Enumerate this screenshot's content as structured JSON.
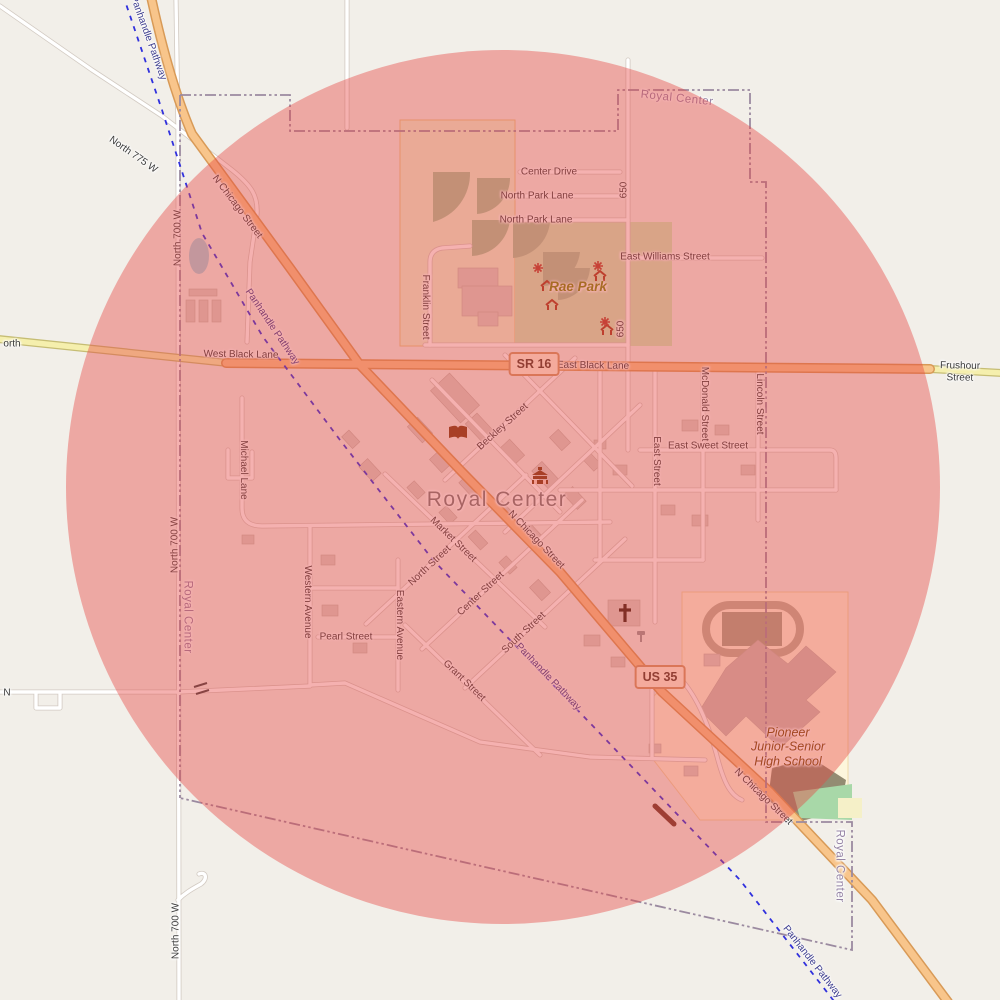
{
  "map": {
    "town_name": "Royal Center",
    "overlay": {
      "shape": "circle",
      "color": "#e84642",
      "opacity": 0.42,
      "cx": 503,
      "cy": 487,
      "r": 437
    },
    "badges": [
      {
        "id": "route-sr16",
        "label": "SR 16",
        "x": 534,
        "y": 364
      },
      {
        "id": "route-us35",
        "label": "US 35",
        "x": 660,
        "y": 677
      }
    ],
    "labels": [
      {
        "text": "orth",
        "x": 12,
        "y": 344,
        "rot": 0,
        "cls": "road"
      },
      {
        "text": "North 775 W",
        "x": 133,
        "y": 155,
        "rot": 35,
        "cls": "road"
      },
      {
        "text": "Panhandle Pathway",
        "x": 148,
        "y": 38,
        "rot": 70,
        "cls": "path-label"
      },
      {
        "text": "N Chicago Street",
        "x": 237,
        "y": 207,
        "rot": 53,
        "cls": "road"
      },
      {
        "text": "North 700 W",
        "x": 178,
        "y": 238,
        "rot": -90,
        "cls": "road"
      },
      {
        "text": "Panhandle Pathway",
        "x": 272,
        "y": 327,
        "rot": 56,
        "cls": "path-label"
      },
      {
        "text": "West Black Lane",
        "x": 241,
        "y": 355,
        "rot": 1,
        "cls": "road"
      },
      {
        "text": "East Black Lane",
        "x": 593,
        "y": 366,
        "rot": 1,
        "cls": "road"
      },
      {
        "text": "Frushour Street",
        "x": 960,
        "y": 372,
        "rot": 1,
        "cls": "road"
      },
      {
        "text": "Royal Center",
        "x": 677,
        "y": 99,
        "rot": 6,
        "cls": "boundary"
      },
      {
        "text": "650",
        "x": 624,
        "y": 190,
        "rot": -90,
        "cls": "road"
      },
      {
        "text": "650",
        "x": 621,
        "y": 329,
        "rot": -90,
        "cls": "road"
      },
      {
        "text": "Center Drive",
        "x": 549,
        "y": 172,
        "rot": 0,
        "cls": "road"
      },
      {
        "text": "North Park Lane",
        "x": 537,
        "y": 196,
        "rot": 0,
        "cls": "road"
      },
      {
        "text": "North Park Lane",
        "x": 536,
        "y": 220,
        "rot": 0,
        "cls": "road"
      },
      {
        "text": "East Williams Street",
        "x": 665,
        "y": 257,
        "rot": 0,
        "cls": "road"
      },
      {
        "text": "Rae Park",
        "x": 578,
        "y": 287,
        "rot": 0,
        "cls": "park"
      },
      {
        "text": "Franklin Street",
        "x": 425,
        "y": 307,
        "rot": 90,
        "cls": "road"
      },
      {
        "text": "Beckley Street",
        "x": 503,
        "y": 427,
        "rot": -42,
        "cls": "road"
      },
      {
        "text": "McDonald Street",
        "x": 704,
        "y": 404,
        "rot": 90,
        "cls": "road"
      },
      {
        "text": "Lincoln Street",
        "x": 759,
        "y": 404,
        "rot": 90,
        "cls": "road"
      },
      {
        "text": "East Street",
        "x": 656,
        "y": 461,
        "rot": 90,
        "cls": "road"
      },
      {
        "text": "East Sweet Street",
        "x": 708,
        "y": 446,
        "rot": 0,
        "cls": "road"
      },
      {
        "text": "Royal Center",
        "x": 497,
        "y": 500,
        "rot": 0,
        "cls": "town"
      },
      {
        "text": "N Chicago Street",
        "x": 536,
        "y": 540,
        "rot": 46,
        "cls": "road"
      },
      {
        "text": "Michael Lane",
        "x": 243,
        "y": 470,
        "rot": 90,
        "cls": "road"
      },
      {
        "text": "Market Street",
        "x": 453,
        "y": 540,
        "rot": 44,
        "cls": "road"
      },
      {
        "text": "North Street",
        "x": 430,
        "y": 566,
        "rot": -43,
        "cls": "road"
      },
      {
        "text": "North 700 W",
        "x": 175,
        "y": 545,
        "rot": -90,
        "cls": "road"
      },
      {
        "text": "Royal Center",
        "x": 187,
        "y": 617,
        "rot": 90,
        "cls": "boundary"
      },
      {
        "text": "Western Avenue",
        "x": 307,
        "y": 602,
        "rot": 90,
        "cls": "road"
      },
      {
        "text": "Eastern Avenue",
        "x": 399,
        "y": 625,
        "rot": 90,
        "cls": "road"
      },
      {
        "text": "Pearl Street",
        "x": 346,
        "y": 637,
        "rot": 0,
        "cls": "road"
      },
      {
        "text": "Center Street",
        "x": 481,
        "y": 594,
        "rot": -43,
        "cls": "road"
      },
      {
        "text": "South Street",
        "x": 524,
        "y": 633,
        "rot": -43,
        "cls": "road"
      },
      {
        "text": "Grant Street",
        "x": 464,
        "y": 681,
        "rot": 44,
        "cls": "road"
      },
      {
        "text": "Panhandle Pathway",
        "x": 548,
        "y": 677,
        "rot": 46,
        "cls": "path-label"
      },
      {
        "text": "N",
        "x": 7,
        "y": 693,
        "rot": 0,
        "cls": "road"
      },
      {
        "text": "Pioneer\nJunior-Senior\nHigh School",
        "x": 788,
        "y": 747,
        "rot": 0,
        "cls": "school"
      },
      {
        "text": "N Chicago Street",
        "x": 763,
        "y": 797,
        "rot": 44,
        "cls": "road"
      },
      {
        "text": "Royal Center",
        "x": 839,
        "y": 866,
        "rot": 90,
        "cls": "boundary"
      },
      {
        "text": "Panhandle Pathway",
        "x": 812,
        "y": 962,
        "rot": 52,
        "cls": "path-label"
      },
      {
        "text": "North 700 W",
        "x": 176,
        "y": 931,
        "rot": -90,
        "cls": "road"
      }
    ],
    "icons": [
      "library-icon",
      "town-hall-icon",
      "church-icon",
      "picnic-shelter-icon",
      "firepit-icon",
      "guidepost-icon",
      "level-crossing-icon"
    ],
    "colors": {
      "background": "#f2efe9",
      "highway_orange": "#f8c58b",
      "highway_casing": "#d89a57",
      "minor_road": "#ffffff",
      "yellow_road": "#f5efad",
      "park_green": "#c9f0c4",
      "school_grounds": "#fdf6dc",
      "building": "#d9d0c9",
      "water": "#aad3df",
      "boundary_purple": "#9b8aa0",
      "pathway_blue": "#3030dd",
      "overlay_red": "#e84642"
    }
  }
}
